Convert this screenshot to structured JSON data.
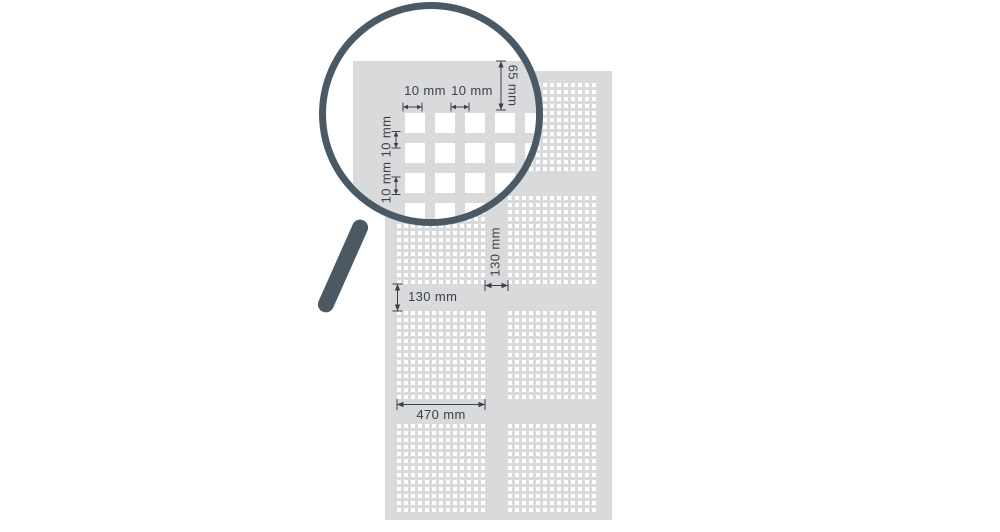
{
  "magnifier": {
    "dim_hole_width": "10 mm",
    "dim_hole_gap_h": "10 mm",
    "dim_hole_gap_v_upper": "10 mm",
    "dim_hole_gap_v_lower": "10 mm",
    "dim_edge_margin": "65 mm"
  },
  "panel": {
    "dim_row_gap": "130 mm",
    "dim_column_gap": "130 mm",
    "dim_block_width": "470 mm"
  },
  "colors": {
    "panel_gray": "#d9dadc",
    "hole_white": "#ffffff",
    "magnifier_slate": "#4b5964",
    "dimension_ink": "#3d4045"
  }
}
